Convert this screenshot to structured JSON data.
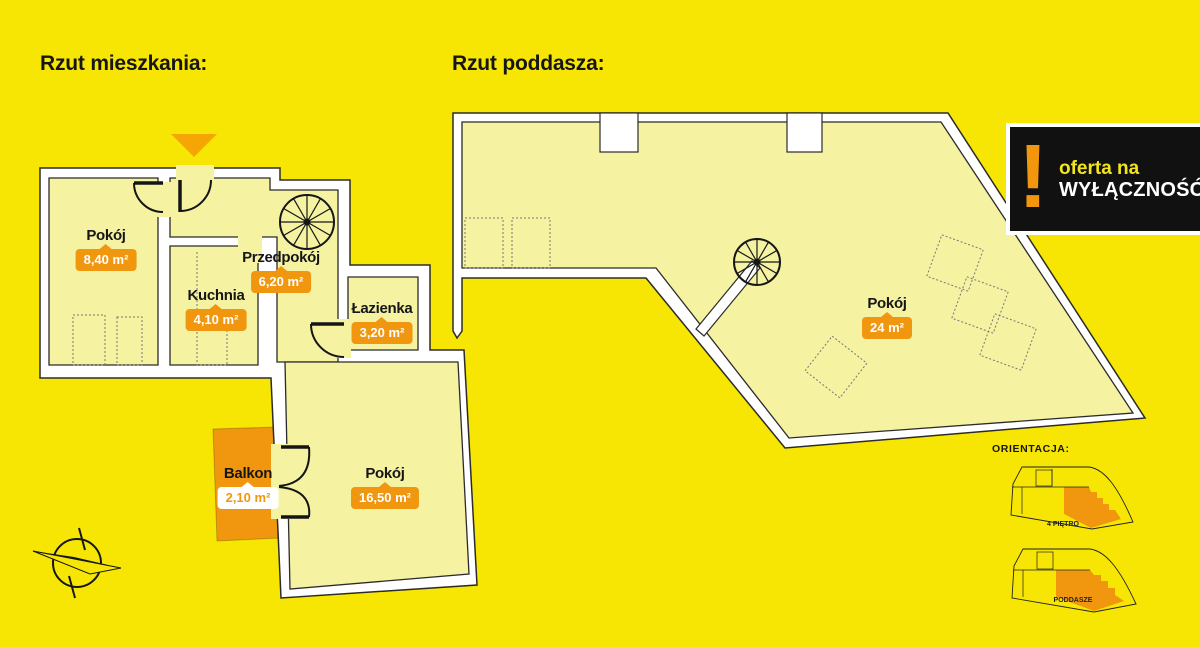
{
  "titles": {
    "apartment": "Rzut mieszkania:",
    "attic": "Rzut poddasza:"
  },
  "offer_badge": {
    "exclamation": "!",
    "line1": "oferta na",
    "line2": "WYŁĄCZNOŚĆ"
  },
  "rooms": [
    {
      "name": "Pokój",
      "area": "8,40 m²"
    },
    {
      "name": "Kuchnia",
      "area": "4,10 m²"
    },
    {
      "name": "Przedpokój",
      "area": "6,20 m²"
    },
    {
      "name": "Łazienka",
      "area": "3,20 m²"
    },
    {
      "name": "Balkon",
      "area": "2,10 m²"
    },
    {
      "name": "Pokój",
      "area": "16,50 m²"
    },
    {
      "name": "Pokój",
      "area": "24 m²"
    }
  ],
  "orientation": {
    "heading": "ORIENTACJA:",
    "floors": [
      {
        "label": "4 PIĘTRO"
      },
      {
        "label": "PODDASZE"
      }
    ]
  },
  "colors": {
    "background": "#F7E603",
    "room_fill": "#F5F2A2",
    "wall": "#FFFFFF",
    "accent_orange": "#F0970F",
    "entrance_arrow": "#F6A604",
    "badge_black": "#111111"
  }
}
